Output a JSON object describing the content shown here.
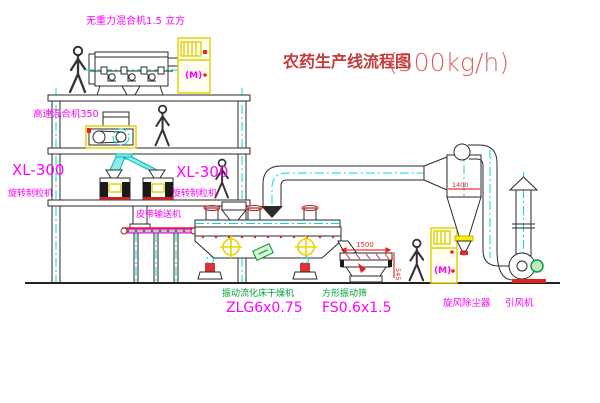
{
  "title": {
    "name": "农药生产线流程图",
    "capacity": "(500kg/h)"
  },
  "equipment_labels": {
    "gravity_mixer": "无重力混合机1.5 立方",
    "high_speed_mixer": "高速混合机350",
    "granulator_left_model": "XL-300",
    "granulator_left_name": "旋转制粒机",
    "granulator_right_model": "XL-300",
    "granulator_right_name": "旋转制粒机",
    "belt_conveyor": "皮带输送机",
    "dryer_name": "振动流化床干燥机",
    "dryer_model": "ZLG6x0.75",
    "sieve_name": "方形振动筛",
    "sieve_model": "FS0.6x1.5",
    "cyclone_name": "旋风除尘器",
    "fan_name": "引风机"
  },
  "dimensions": {
    "cyclone_width": "1400",
    "sieve_length": "1500",
    "sieve_height": "545"
  },
  "symbols": {
    "cabinet_motor": "(M)"
  },
  "colors": {
    "label_magenta": "#ff00ff",
    "label_green": "#00a33c",
    "title_red": "#c43b3b",
    "title_red_light": "#e06060",
    "dim_red": "#ee2222",
    "centerline_cyan": "#00dcdc",
    "equipment_yellow": "#e0d000"
  }
}
